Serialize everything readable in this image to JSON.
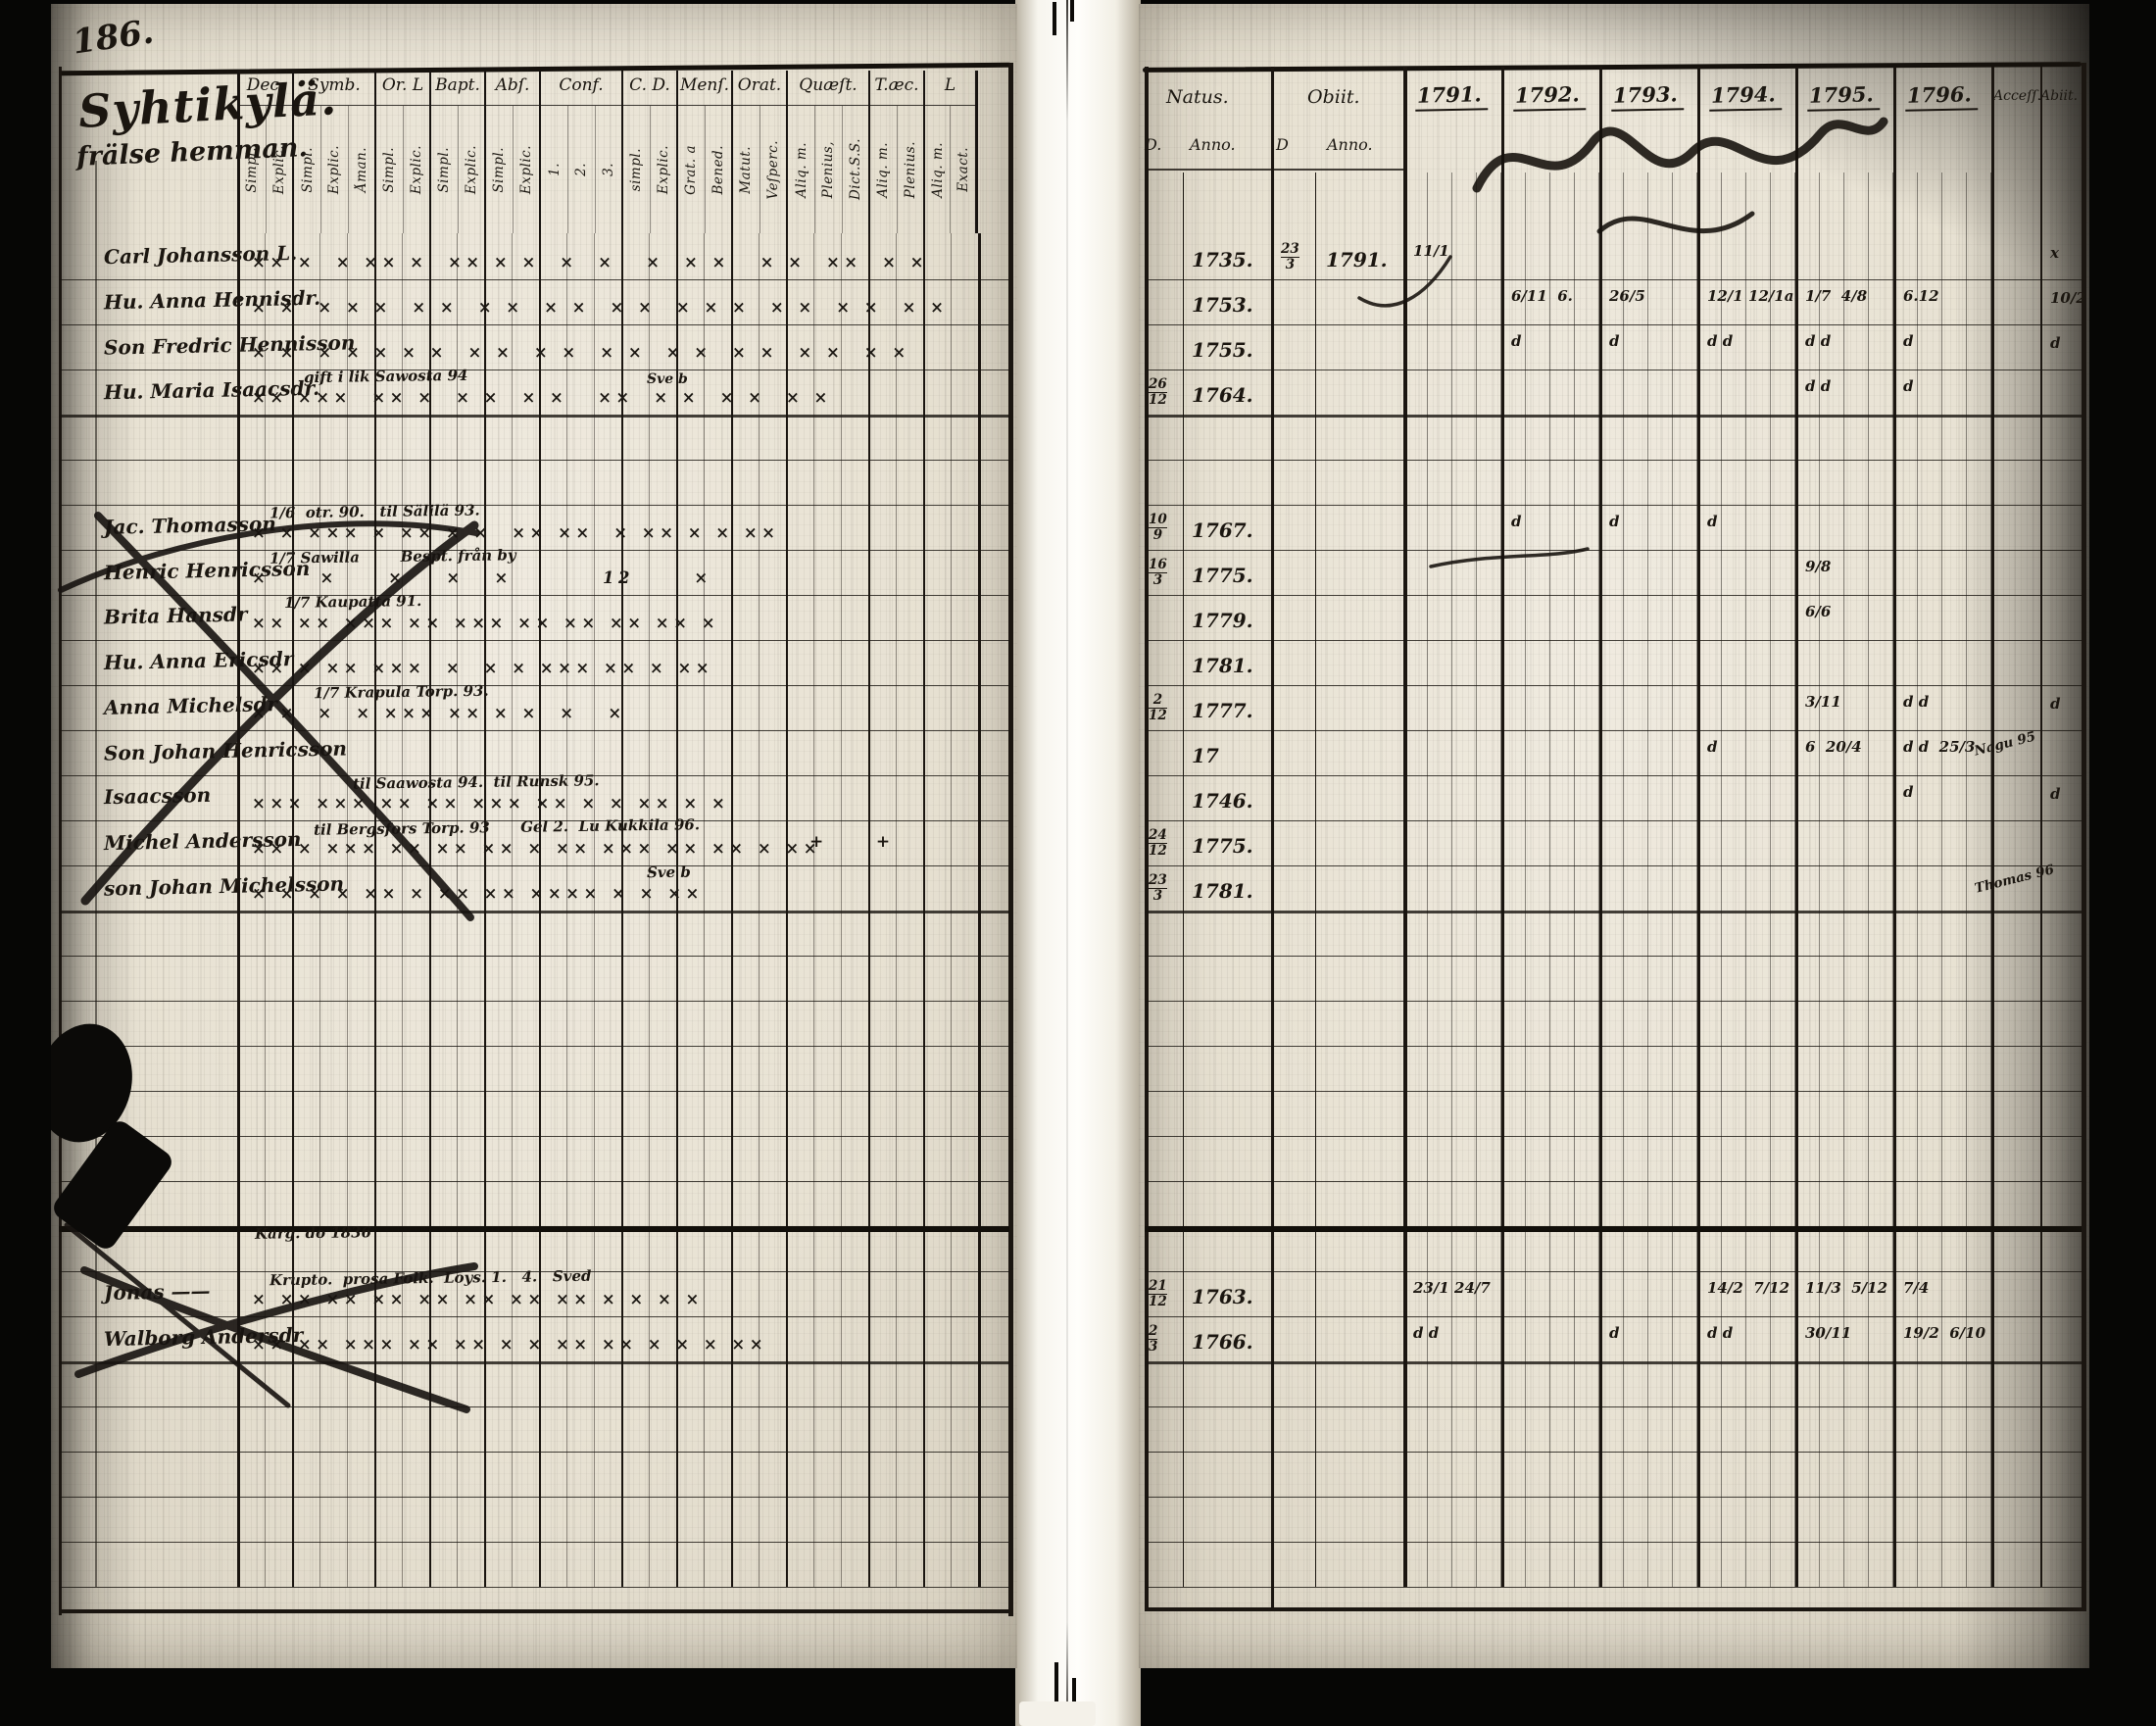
{
  "page_number": "186.",
  "left_page": {
    "title": "Syhtikylä.",
    "subtitle": "frälse hemman.",
    "column_groups": [
      {
        "label": "Dec.",
        "subs": [
          "Simpl.",
          "Explic."
        ]
      },
      {
        "label": "Symb.",
        "subs": [
          "Simpl.",
          "Explic.",
          "Åman."
        ]
      },
      {
        "label": "Or. L",
        "subs": [
          "Simpl.",
          "Explic."
        ]
      },
      {
        "label": "Bapt.",
        "subs": [
          "Simpl.",
          "Explic."
        ]
      },
      {
        "label": "Abſ.",
        "subs": [
          "Simpl.",
          "Explic."
        ]
      },
      {
        "label": "Conf.",
        "subs": [
          "1.",
          "2.",
          "3."
        ]
      },
      {
        "label": "C. D.",
        "subs": [
          "simpl.",
          "Explic."
        ]
      },
      {
        "label": "Menſ.",
        "subs": [
          "Grat. a",
          "Bened."
        ]
      },
      {
        "label": "Orat.",
        "subs": [
          "Matut.",
          "Veſperc."
        ]
      },
      {
        "label": "Quæſt.",
        "subs": [
          "Aliq. m.",
          "Plenius,",
          "Dict.S.S."
        ]
      },
      {
        "label": "T.æc.",
        "subs": [
          "Aliq. m.",
          "Plenius."
        ]
      },
      {
        "label": "L",
        "subs": [
          "Aliq. m.",
          "Exact."
        ]
      }
    ],
    "row_count": 30,
    "rows": [
      {
        "i": 0,
        "name": "Carl Johansson L.",
        "marks": "×× ×  × ×× ×  ×× × ×  ×  ×   ×  × ×   × ×  ××  × ×"
      },
      {
        "i": 1,
        "name": "Hu. Anna Hennisdr.",
        "marks": "× ×  × × ×  × ×  × ×  × ×  × ×  × × ×  × ×  × ×  × ×"
      },
      {
        "i": 2,
        "name": "Son Fredric Hennisson",
        "marks": "× ×  × × × × ×  × ×  × ×  × ×  × ×  × ×  × ×  × ×"
      },
      {
        "i": 3,
        "name": "Hu. Maria Isaacsdr.",
        "note": "gift i lik Sawosta 94",
        "note2": "Sve b",
        "marks": "×× ×××  ×× ×  × ×  × ×   ××  × ×  × ×  × ×"
      },
      {
        "i": 6,
        "name": "Jac. Thomasson",
        "crossed": true,
        "note": "1/6  otr. 90.   til Sälilä 93.",
        "marks": "× × ××× × ×× × ×  ×× ××  × ×× × × ××"
      },
      {
        "i": 7,
        "name": "Henric Henricsson",
        "crossed": true,
        "note": "1/7 Sawilla        Bespt. från by",
        "marks": "×     ×     ×    ×   ×         12      ×"
      },
      {
        "i": 8,
        "name": "Brita Hansdr",
        "crossed": true,
        "note": "1/7 Kaupatta 91.",
        "marks": "×× ×× ××× ×× ××× ×× ×× ×× ×× ×"
      },
      {
        "i": 9,
        "name": "Hu. Anna Ericsdr",
        "marks": "×× × ×× ×××  ×  × × ××× ×× × ××"
      },
      {
        "i": 10,
        "name": "Anna Michelsdr",
        "note": "1/7 Krapula Torp. 93.",
        "marks": "× ×  ×  × ××× ×× × ×  ×   ×"
      },
      {
        "i": 11,
        "name": "Son Johan Henricsson",
        "marks": ""
      },
      {
        "i": 12,
        "name": "Isaacsson",
        "note": "til Saawosta 94.  til Runsk 95.",
        "marks": "××× ××× ×× ×× ××× ×× × × ×× × ×"
      },
      {
        "i": 13,
        "name": "Michel Andersson",
        "note": "til Bergsfors Torp. 93      Gel 2.  Lu Kukkila 96.",
        "marks": "×× × ××× ×× ×× ×× × ×× ××× ×× ×× × ××",
        "extra": "+    +"
      },
      {
        "i": 14,
        "name": "son Johan Michelsson",
        "note": "Sve b",
        "marks": "× × × × ×× × ×× ×× ×××× × × ××"
      },
      {
        "i": 22,
        "note": "Karg. do 1836"
      },
      {
        "i": 23,
        "name": "Jonas ——",
        "crossed": true,
        "note": "Krupto.  prosa Folk.  Loys. 1.   4.   Sved",
        "marks": "× ×× ×× ×× ×× ×× ×× ×× × × × ×"
      },
      {
        "i": 24,
        "name": "Walborg Andersdr",
        "marks": "×× ×× ××× ×× ×× × × ×× ×× × × × ××"
      }
    ]
  },
  "right_page": {
    "headers": {
      "natus": "Natus.",
      "obiit": "Obiit.",
      "d1": "D.",
      "anno1": "Anno.",
      "d2": "D",
      "anno2": "Anno.",
      "accessit": "Acceſſ.",
      "abiit": "Abiit.",
      "years": [
        "1791.",
        "1792.",
        "1793.",
        "1794.",
        "1795.",
        "1796."
      ]
    },
    "row_count": 30,
    "rows": [
      {
        "i": 0,
        "na": "1735.",
        "od": "23/3",
        "oa": "1791.",
        "y": [
          "11/1",
          "",
          "",
          "",
          "",
          ""
        ],
        "ab": "x"
      },
      {
        "i": 1,
        "na": "1753.",
        "y": [
          "",
          "6/11  6.",
          "26/5",
          "12/1 12/1a",
          "1/7  4/8",
          "6.12"
        ],
        "ab": "10/2"
      },
      {
        "i": 2,
        "na": "1755.",
        "y": [
          "",
          "d",
          "d",
          "d d",
          "d d",
          "d"
        ],
        "ab": "d"
      },
      {
        "i": 3,
        "nd": "26/12",
        "na": "1764.",
        "y": [
          "",
          "",
          "",
          "",
          "d d",
          "d"
        ]
      },
      {
        "i": 6,
        "nd": "10/9",
        "na": "1767.",
        "y": [
          "",
          "d",
          "d",
          "d",
          "",
          ""
        ]
      },
      {
        "i": 7,
        "nd": "16/3",
        "na": "1775.",
        "y": [
          "",
          "",
          "",
          "",
          "9/8",
          ""
        ]
      },
      {
        "i": 8,
        "na": "1779.",
        "y": [
          "",
          "",
          "",
          "",
          "6/6",
          ""
        ]
      },
      {
        "i": 9,
        "na": "1781."
      },
      {
        "i": 10,
        "nd": "2/12",
        "na": "1777.",
        "y": [
          "",
          "",
          "",
          "",
          "3/11",
          "d d"
        ],
        "ab": "d"
      },
      {
        "i": 11,
        "na": "17",
        "y": [
          "",
          "",
          "",
          "d",
          "6  20/4",
          "d d  25/3"
        ],
        "ac": "Nagu 95"
      },
      {
        "i": 12,
        "na": "1746.",
        "y": [
          "",
          "",
          "",
          "",
          "",
          "d"
        ],
        "ab": "d"
      },
      {
        "i": 13,
        "nd": "24/12",
        "na": "1775."
      },
      {
        "i": 14,
        "nd": "23/3",
        "na": "1781.",
        "ac": "Thomas 96"
      },
      {
        "i": 23,
        "nd": "21/12",
        "na": "1763.",
        "y": [
          "23/1 24/7",
          "",
          "",
          "14/2  7/12",
          "11/3  5/12",
          "7/4"
        ]
      },
      {
        "i": 24,
        "nd": "2/3",
        "na": "1766.",
        "y": [
          "d d",
          "",
          "d",
          "d d",
          "30/11",
          "19/2  6/10"
        ]
      }
    ]
  }
}
